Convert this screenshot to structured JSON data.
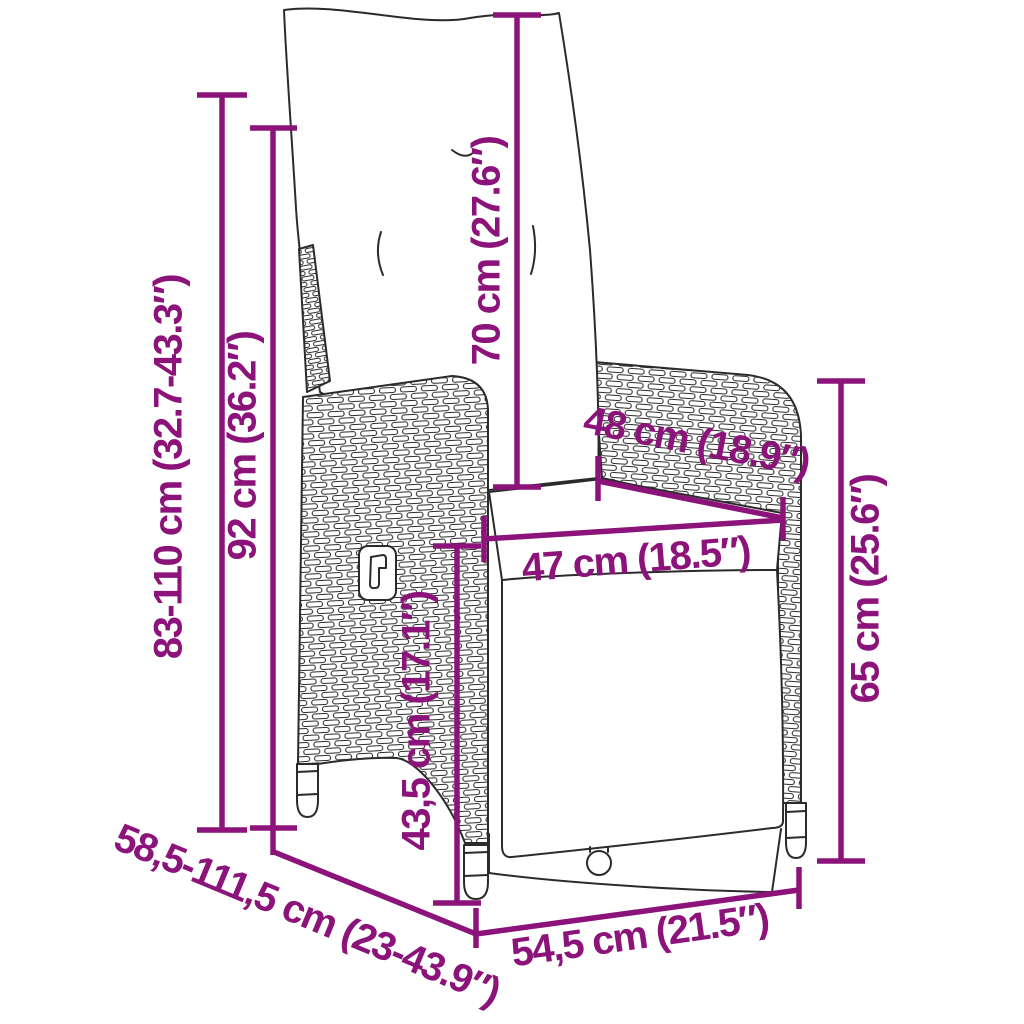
{
  "diagram": {
    "type": "furniture-dimension-diagram",
    "subject": "reclining rattan garden chair with cushions",
    "accent_color": "#8B1379",
    "line_color": "#2B2B2B",
    "background": "#FFFFFF",
    "dimensions": [
      {
        "id": "overall-height",
        "label": "83-110 cm (32.7-43.3″)",
        "orientation": "vertical"
      },
      {
        "id": "backrest-height",
        "label": "92 cm (36.2″)",
        "orientation": "vertical"
      },
      {
        "id": "back-cushion-height",
        "label": "70 cm (27.6″)",
        "orientation": "vertical"
      },
      {
        "id": "seat-depth",
        "label": "48 cm (18.9″)",
        "orientation": "diagonal"
      },
      {
        "id": "seat-width",
        "label": "47 cm (18.5″)",
        "orientation": "horizontal"
      },
      {
        "id": "seat-height",
        "label": "43,5 cm (17.1″)",
        "orientation": "vertical"
      },
      {
        "id": "armrest-height",
        "label": "65 cm (25.6″)",
        "orientation": "vertical"
      },
      {
        "id": "overall-depth",
        "label": "58,5-111,5 cm (23-43.9″)",
        "orientation": "diagonal"
      },
      {
        "id": "overall-width",
        "label": "54,5 cm (21.5″)",
        "orientation": "diagonal"
      }
    ]
  }
}
